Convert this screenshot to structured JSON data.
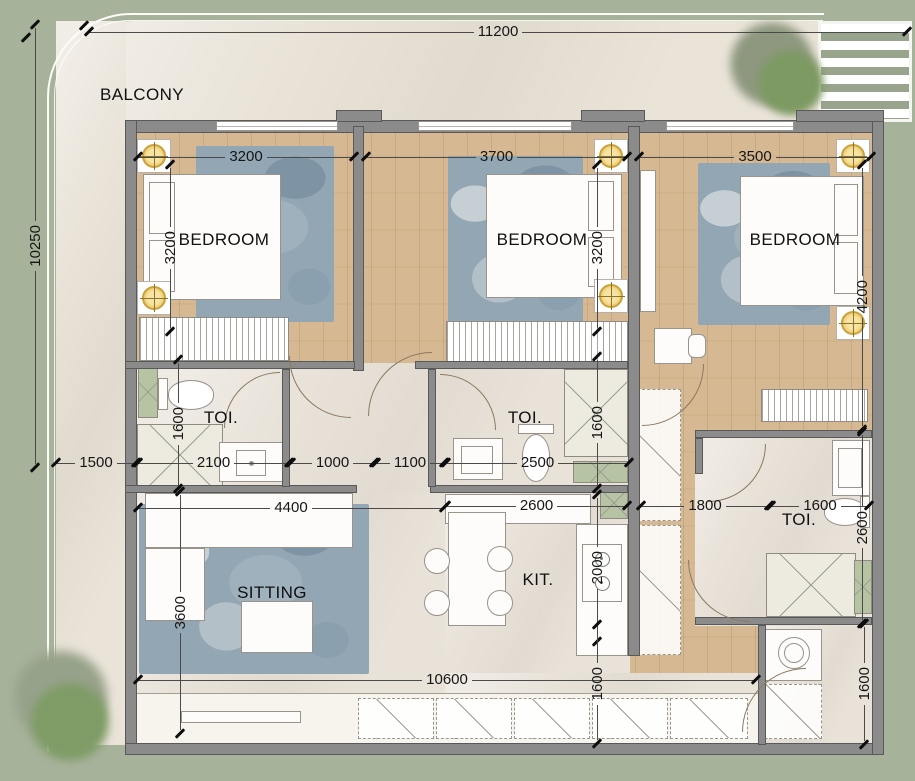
{
  "rooms": {
    "balcony": "BALCONY",
    "b1": "BEDROOM",
    "b2": "BEDROOM",
    "b3": "BEDROOM",
    "t1": "TOI.",
    "t2": "TOI.",
    "t3": "TOI.",
    "sitting": "SITTING",
    "kitchen": "KIT."
  },
  "dims": {
    "top": "11200",
    "left": "10250",
    "balcony": "1500",
    "b1w": "3200",
    "b1d": "3200",
    "b2w": "3700",
    "b2d": "3200",
    "b3w": "3500",
    "b3d": "4200",
    "t1h": "1600",
    "t1w": "2100",
    "hall_door": "1000",
    "hall": "1100",
    "t2w": "2500",
    "t2h": "1600",
    "kitw": "2600",
    "corr": "1800",
    "t3w": "1600",
    "t3d": "2600",
    "stove": "2000",
    "sitw": "4400",
    "sitd": "3600",
    "bottom": "10600",
    "kitp": "1600",
    "laund": "1600"
  },
  "colors": {
    "background_green": "#a7b29a",
    "balcony_cream": "#e9e3d8",
    "wood_floor": "#d6b992",
    "tile_floor": "#e8e2d9",
    "wall_gray": "#8b8b8b",
    "rug_blue": "#93a6b3",
    "light_yellow": "#edc968",
    "shaft_green": "#b7c4a4"
  }
}
